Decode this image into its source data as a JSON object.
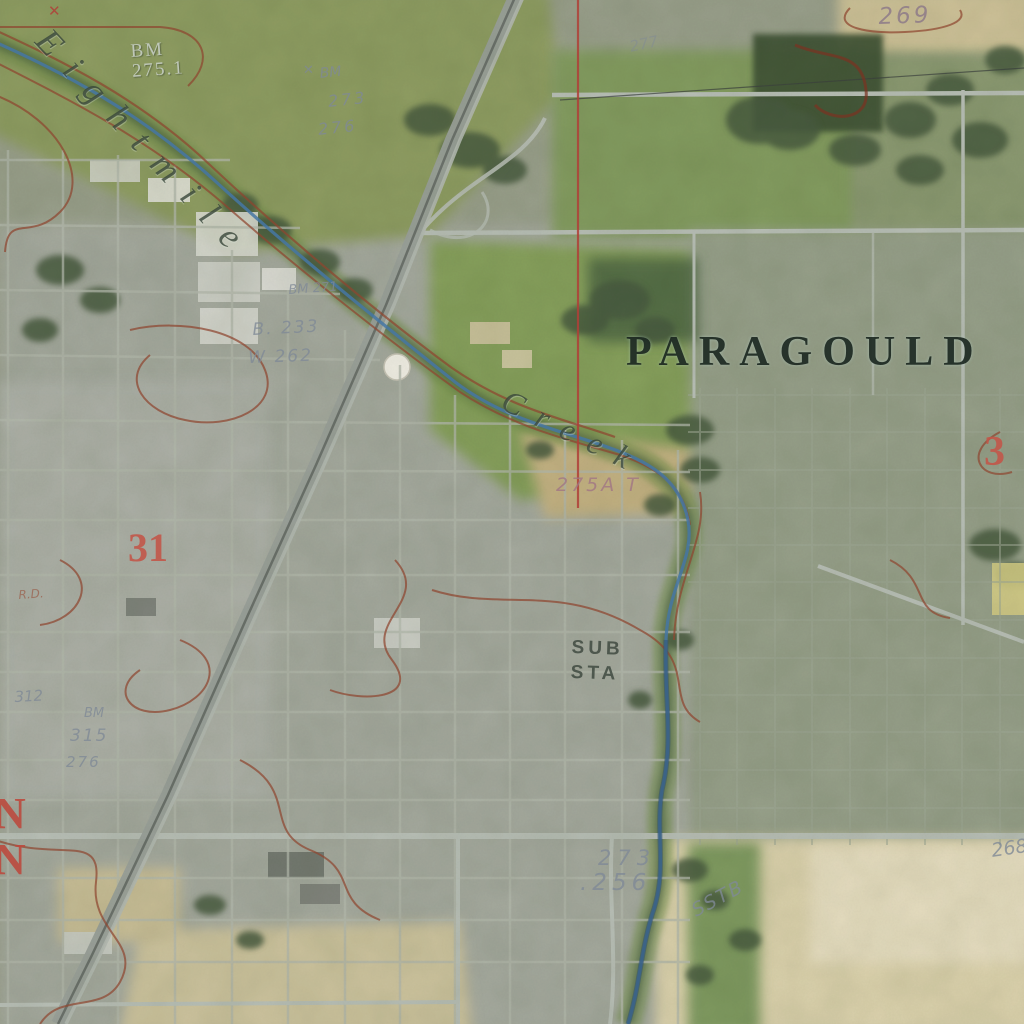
{
  "map": {
    "description": "USGS topographic overlay on aerial photo, Paragould area",
    "place": "Paragould"
  },
  "labels": {
    "place_name": "PARAGOULD",
    "stream_name_upper": "Eightmile",
    "stream_name_lower": "Creek",
    "benchmark_top": "BM",
    "benchmark_top_elev": "275.1",
    "contour_elev_269": "269",
    "corner_cross": "✕",
    "note_cross_top": "✕",
    "note_bm_273": "BM",
    "note_273_top": "273",
    "note_276_top": "276",
    "note_bm_271": "BM 271",
    "note_b233": "B. 233",
    "note_w262": "W 262",
    "note_277": "277",
    "spot_elev_275a": "275A T",
    "section_31": "31",
    "section_3": "3",
    "substation_line1": "SUB",
    "substation_line2": "STA",
    "note_273_lower": "273",
    "note_256": ".256",
    "note_sstb": "SSTB",
    "margin_n_upper": "N",
    "margin_n_lower": "N",
    "note_rd": "R.D.",
    "note_312": "312",
    "note_bm_left": "BM",
    "note_315": "315",
    "note_276_left": "276",
    "note_268": "268"
  },
  "colors": {
    "contour_red": "#8f4630",
    "boundary_red": "#b04038",
    "section_red": "#c25749",
    "creek_blue": "#4577a4",
    "handwriting_gray": "#808a96",
    "place_dark": "#16211a",
    "field_cream": "#dcd2ad",
    "grass_green": "#8f9d62",
    "urban_gray": "#a5a99e"
  }
}
